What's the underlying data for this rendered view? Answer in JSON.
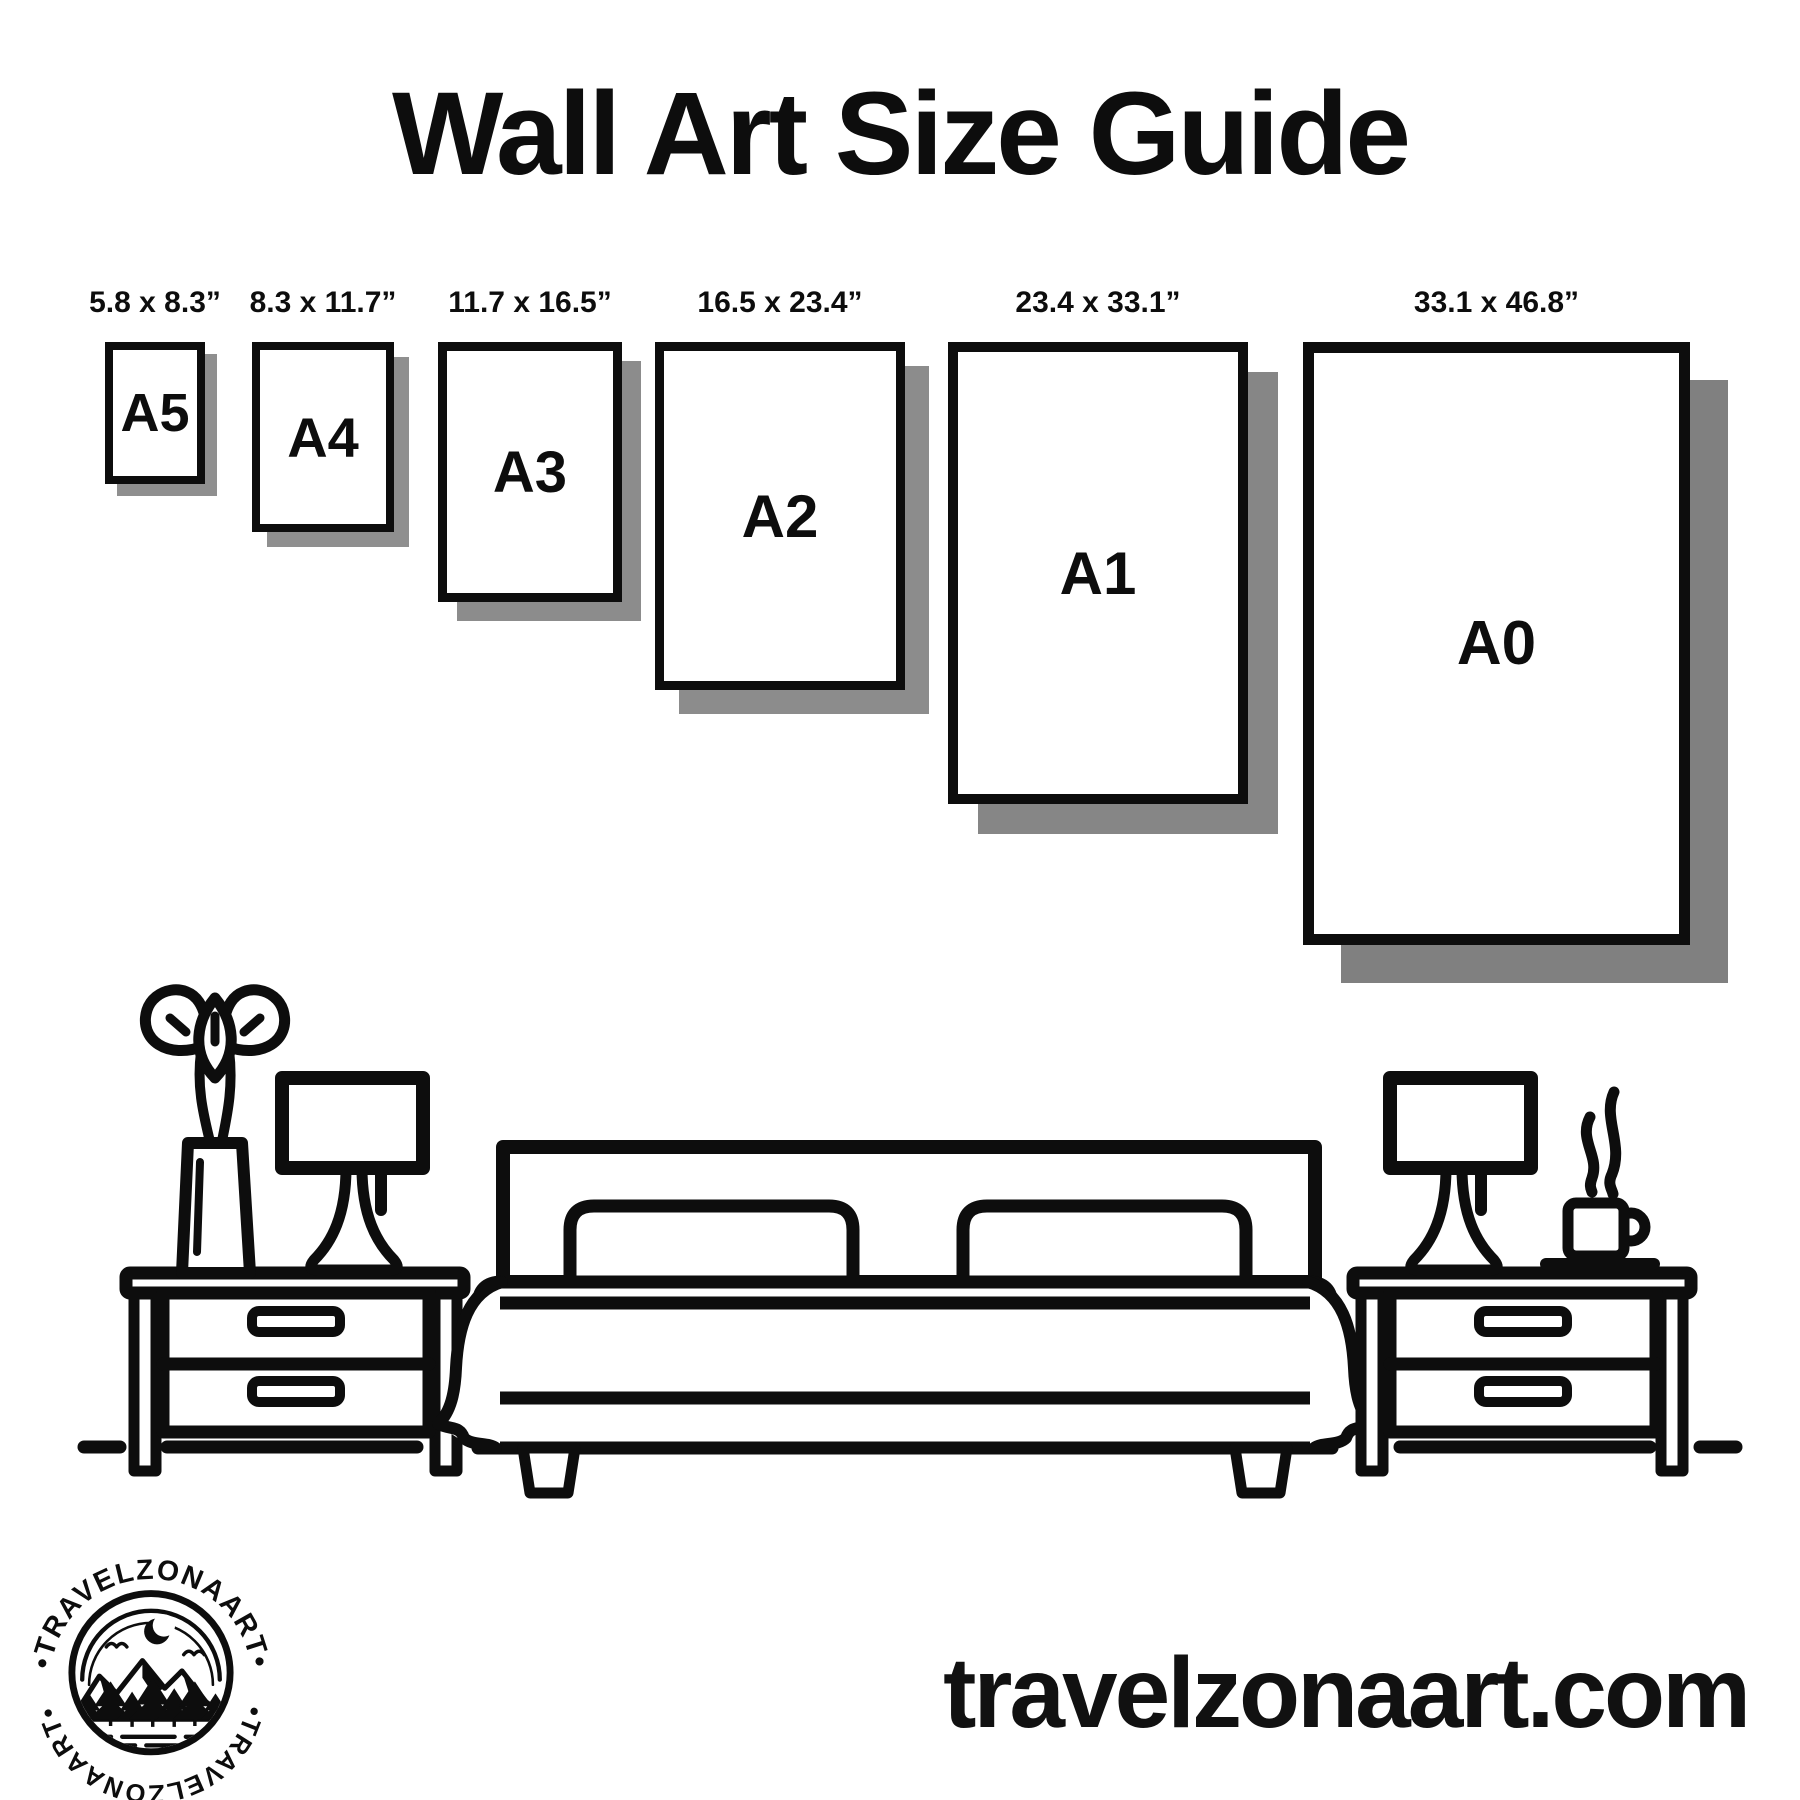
{
  "page": {
    "title": "Wall Art Size Guide",
    "website_url": "travelzonaart.com"
  },
  "colors": {
    "background": "#ffffff",
    "ink": "#0d0d0d",
    "frame_shadow": "#8c8c8c"
  },
  "frames": [
    {
      "label": "A5",
      "dimensions": "5.8 x 8.3”"
    },
    {
      "label": "A4",
      "dimensions": "8.3 x 11.7”"
    },
    {
      "label": "A3",
      "dimensions": "11.7 x 16.5”"
    },
    {
      "label": "A2",
      "dimensions": "16.5 x 23.4”"
    },
    {
      "label": "A1",
      "dimensions": "23.4 x 33.1”"
    },
    {
      "label": "A0",
      "dimensions": "33.1 x 46.8”"
    }
  ],
  "logo": {
    "arc_text_top": "•TRAVELZONAART•",
    "arc_text_bottom": "•TRAVELZONAART•"
  }
}
